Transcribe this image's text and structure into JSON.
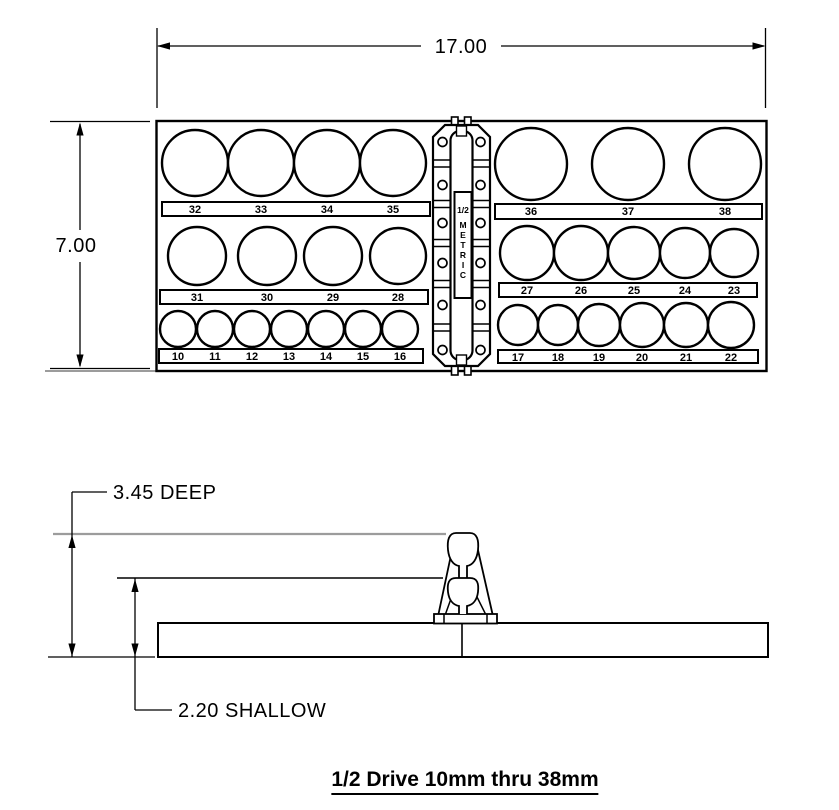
{
  "drawing": {
    "dim_width": "17.00",
    "dim_height": "7.00",
    "dim_deep": "3.45 DEEP",
    "dim_shallow": "2.20 SHALLOW",
    "title": "1/2 Drive 10mm thru 38mm"
  },
  "rail": {
    "size_label": "1/2",
    "system_label": "METRIC"
  },
  "socket_groups": [
    {
      "name": "left-row-1",
      "sockets": [
        "32",
        "33",
        "34",
        "35"
      ]
    },
    {
      "name": "right-row-1",
      "sockets": [
        "36",
        "37",
        "38"
      ]
    },
    {
      "name": "left-row-2",
      "sockets": [
        "31",
        "30",
        "29",
        "28"
      ]
    },
    {
      "name": "right-row-2",
      "sockets": [
        "27",
        "26",
        "25",
        "24",
        "23"
      ]
    },
    {
      "name": "left-row-3",
      "sockets": [
        "10",
        "11",
        "12",
        "13",
        "14",
        "15",
        "16"
      ]
    },
    {
      "name": "right-row-3",
      "sockets": [
        "17",
        "18",
        "19",
        "20",
        "21",
        "22"
      ]
    }
  ],
  "colors": {
    "line": "#000000",
    "reference_gray": "#9c9c9c",
    "background": "#ffffff"
  }
}
